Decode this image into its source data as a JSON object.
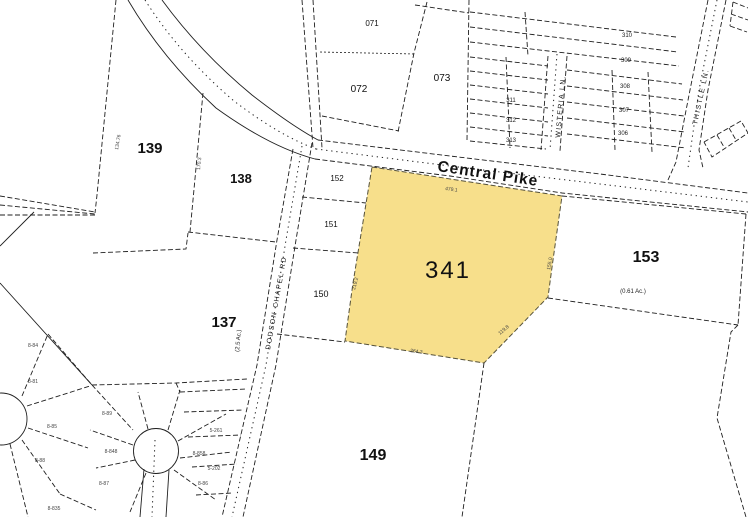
{
  "roads": {
    "central_pike": "Central Pike",
    "dodson_chapel_rd": "DODSON CHAPEL RD",
    "wisteria_ln": "WISTERIA LN.",
    "thistle_ln": "THISTLE LN."
  },
  "parcels": {
    "p341": "341",
    "p139": "139",
    "p138": "138",
    "p137": "137",
    "p149": "149",
    "p153": "153",
    "p150": "150",
    "p151": "151",
    "p152": "152",
    "p071": "071",
    "p072": "072",
    "p073": "073",
    "acreage_153": "(0.61 Ac.)",
    "acreage_137": "(2.5 Ac.)"
  },
  "subdivision_lots": [
    "310",
    "309",
    "308",
    "307",
    "306",
    "311",
    "312",
    "313"
  ],
  "small_lot_labels": [
    "8-84",
    "8-85",
    "8-88",
    "8-835",
    "8-89",
    "8-848",
    "8-87",
    "8-858",
    "8-86",
    "5-261",
    "5-202",
    "8-81"
  ],
  "dimension_texts": [
    "134.76",
    "170.3",
    "479.1",
    "219.2",
    "155.0",
    "264.3",
    "119.8"
  ],
  "colors": {
    "highlight_fill": "#F7DF8B",
    "highlight_label": "#8F7C1E",
    "line": "#1f1f1f",
    "background": "#FFFFFF"
  }
}
